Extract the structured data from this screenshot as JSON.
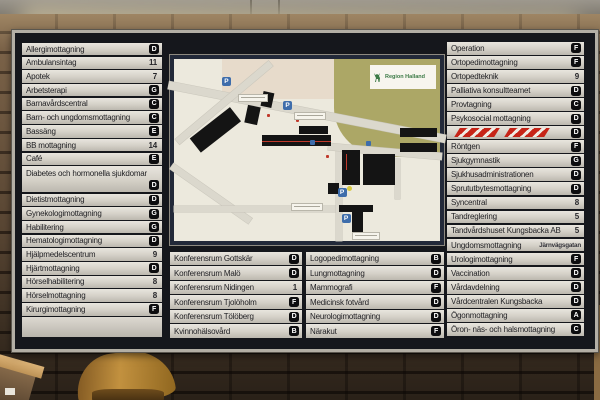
{
  "scene": {
    "map_logo": "Region Halland",
    "parking_label": "P"
  },
  "colors": {
    "board_background": "#15171c",
    "row_strip": "#d4d0c7",
    "badge_black": "#0d0d0f",
    "map_frame_navy": "#222939",
    "map_paper": "#ece9dd",
    "park_olive": "#aca766",
    "parking_blue": "#3e6dab",
    "hazard_red": "#c62418",
    "brick_brown": "#6d563f",
    "lamp_warm_white": "#fffbe9",
    "chair_wood": "#c2913f"
  },
  "directory": {
    "left": [
      {
        "label": "Allergimottagning",
        "code": "D",
        "type": "badge"
      },
      {
        "label": "Ambulansintag",
        "code": "11",
        "type": "number"
      },
      {
        "label": "Apotek",
        "code": "7",
        "type": "number"
      },
      {
        "label": "Arbetsterapi",
        "code": "G",
        "type": "badge"
      },
      {
        "label": "Barnavårdscentral",
        "code": "C",
        "type": "badge"
      },
      {
        "label": "Barn- och ungdomsmottagning",
        "code": "C",
        "type": "badge"
      },
      {
        "label": "Bassäng",
        "code": "E",
        "type": "badge"
      },
      {
        "label": "BB mottagning",
        "code": "14",
        "type": "number"
      },
      {
        "label": "Café",
        "code": "E",
        "type": "badge"
      },
      {
        "label": "Diabetes och hormonella sjukdomar",
        "code": "D",
        "type": "badge",
        "tall": true
      },
      {
        "label": "Dietistmottagning",
        "code": "D",
        "type": "badge"
      },
      {
        "label": "Gynekologimottagning",
        "code": "G",
        "type": "badge"
      },
      {
        "label": "Habilitering",
        "code": "G",
        "type": "badge"
      },
      {
        "label": "Hematologimottagning",
        "code": "D",
        "type": "badge"
      },
      {
        "label": "Hjälpmedelscentrum",
        "code": "9",
        "type": "number"
      },
      {
        "label": "Hjärtmottagning",
        "code": "D",
        "type": "badge"
      },
      {
        "label": "Hörselhabilitering",
        "code": "8",
        "type": "number"
      },
      {
        "label": "Hörselmottagning",
        "code": "8",
        "type": "number"
      },
      {
        "label": "Kirurgimottagning",
        "code": "F",
        "type": "badge"
      }
    ],
    "right": [
      {
        "label": "Operation",
        "code": "F",
        "type": "badge"
      },
      {
        "label": "Ortopedimottagning",
        "code": "F",
        "type": "badge"
      },
      {
        "label": "Ortopedteknik",
        "code": "9",
        "type": "number"
      },
      {
        "label": "Palliativa konsultteamet",
        "code": "D",
        "type": "badge"
      },
      {
        "label": "Provtagning",
        "code": "C",
        "type": "badge"
      },
      {
        "label": "Psykosocial mottagning",
        "code": "D",
        "type": "badge"
      },
      {
        "label": "",
        "code": "D",
        "type": "badge",
        "striped": true
      },
      {
        "label": "Röntgen",
        "code": "F",
        "type": "badge"
      },
      {
        "label": "Sjukgymnastik",
        "code": "G",
        "type": "badge"
      },
      {
        "label": "Sjukhusadministrationen",
        "code": "D",
        "type": "badge"
      },
      {
        "label": "Sprututbytesmottagning",
        "code": "D",
        "type": "badge"
      },
      {
        "label": "Syncentral",
        "code": "8",
        "type": "number"
      },
      {
        "label": "Tandreglering",
        "code": "5",
        "type": "number"
      },
      {
        "label": "Tandvårdshuset Kungsbacka AB",
        "code": "5",
        "type": "number"
      },
      {
        "label": "Ungdomsmottagning",
        "code": "Järnvägsgatan",
        "type": "text"
      },
      {
        "label": "Urologimottagning",
        "code": "F",
        "type": "badge"
      },
      {
        "label": "Vaccination",
        "code": "D",
        "type": "badge"
      },
      {
        "label": "Vårdavdelning",
        "code": "D",
        "type": "badge"
      },
      {
        "label": "Vårdcentralen Kungsbacka",
        "code": "D",
        "type": "badge"
      },
      {
        "label": "Ögonmottagning",
        "code": "A",
        "type": "badge"
      },
      {
        "label": "Öron- näs- och halsmottagning",
        "code": "C",
        "type": "badge"
      }
    ],
    "bottom_left": [
      {
        "label": "Konferensrum Gottskär",
        "code": "D",
        "type": "badge"
      },
      {
        "label": "Konferensrum Malö",
        "code": "D",
        "type": "badge"
      },
      {
        "label": "Konferensrum Nidingen",
        "code": "1",
        "type": "number"
      },
      {
        "label": "Konferensrum Tjolöholm",
        "code": "F",
        "type": "badge"
      },
      {
        "label": "Konferensrum Tölöberg",
        "code": "D",
        "type": "badge"
      },
      {
        "label": "Kvinnohälsovård",
        "code": "B",
        "type": "badge"
      }
    ],
    "bottom_right": [
      {
        "label": "Logopedimottagning",
        "code": "B",
        "type": "badge"
      },
      {
        "label": "Lungmottagning",
        "code": "D",
        "type": "badge"
      },
      {
        "label": "Mammografi",
        "code": "F",
        "type": "badge"
      },
      {
        "label": "Medicinsk fotvård",
        "code": "D",
        "type": "badge"
      },
      {
        "label": "Neurologimottagning",
        "code": "D",
        "type": "badge"
      },
      {
        "label": "Närakut",
        "code": "F",
        "type": "badge"
      }
    ]
  }
}
